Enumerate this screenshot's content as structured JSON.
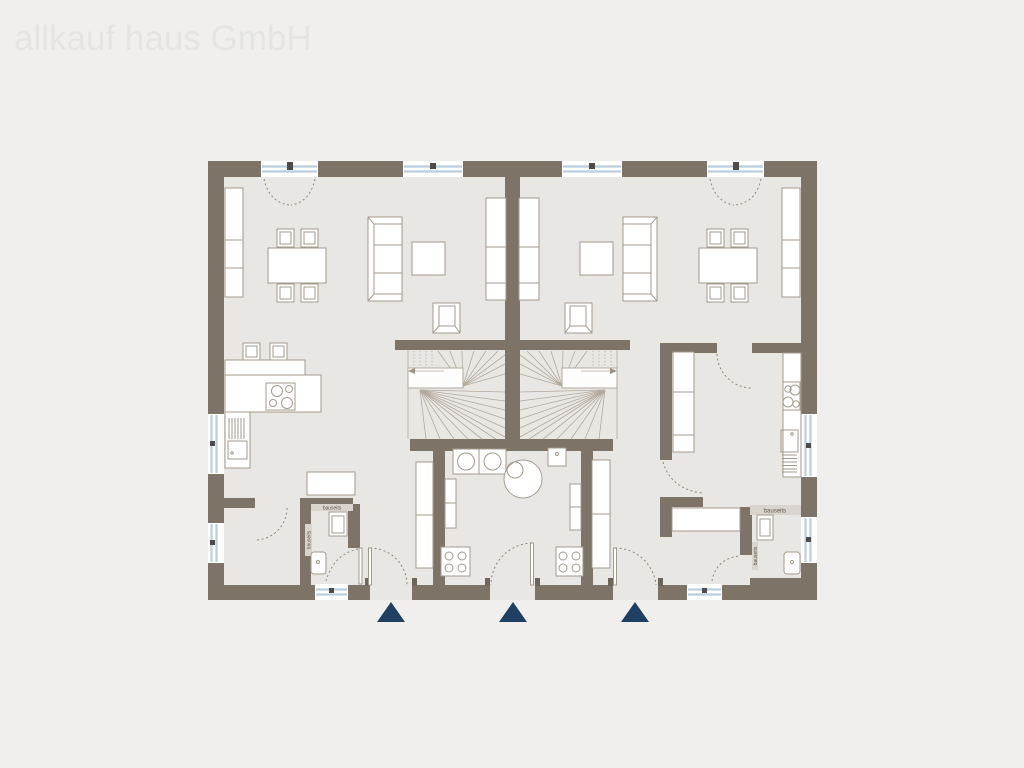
{
  "watermark": "allkauf haus GmbH",
  "plan": {
    "type": "semi-detached-house-ground-floor-plan",
    "site_labels": {
      "left_wc_top": "bauseits",
      "left_wc_side": "bauseits",
      "right_wc_top": "bauseits",
      "right_wc_side": "bauseits"
    },
    "entrance_markers": 3
  },
  "colors": {
    "background": "#f0efed",
    "floor": "#e9e7e4",
    "wall": "#7d7467",
    "wall_light": "#d9d4cd",
    "furniture_stroke": "#a39a8c",
    "stair_stroke": "#b2a99d",
    "dash_stroke": "#8d8579",
    "window_blue": "#b9cedf",
    "window_dark": "#4c4c4c",
    "door_tab": "#6e665a",
    "entrance_marker": "#1f3f63",
    "bauseits_text": "#5c5549",
    "watermark": "#e4e4e2"
  }
}
